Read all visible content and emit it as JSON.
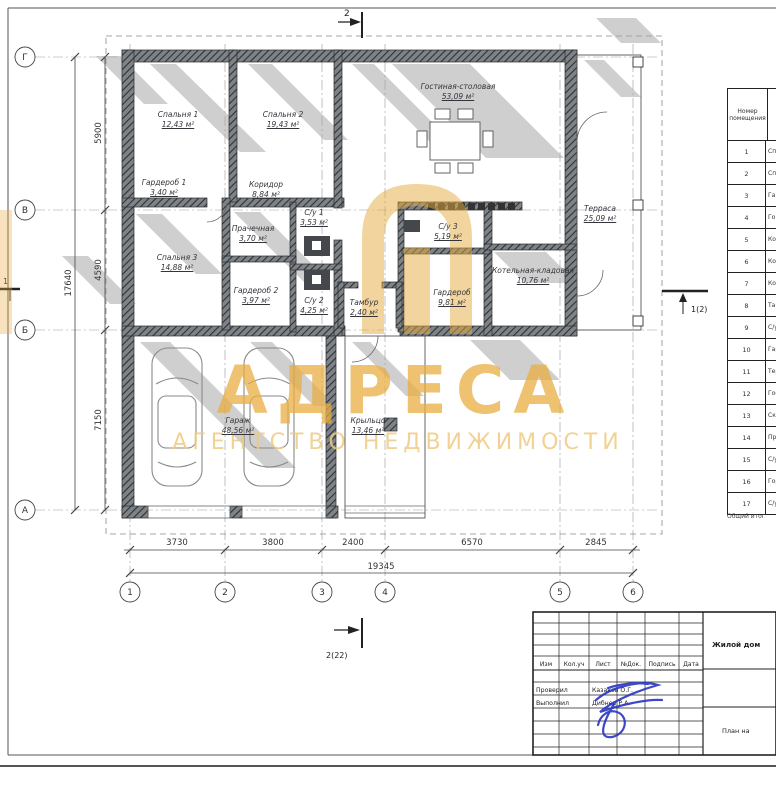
{
  "watermark": {
    "title": "АДРЕСА",
    "subtitle": "АГЕНТСТВО НЕДВИЖИМОСТИ",
    "accent_color": "#e8ad42"
  },
  "axes": {
    "rows": [
      "Г",
      "В",
      "Б",
      "А"
    ],
    "cols": [
      "1",
      "2",
      "3",
      "4",
      "5",
      "6"
    ]
  },
  "dimensions": {
    "bottom_segments": [
      "3730",
      "3800",
      "2400",
      "6570",
      "2845"
    ],
    "bottom_total": "19345",
    "left_segments": [
      "5900",
      "4590",
      "7150"
    ],
    "left_total": "17640"
  },
  "section_marks": {
    "top": "2",
    "bottom": "2(22)",
    "right": "1(2)",
    "left": "1"
  },
  "rooms": [
    {
      "name": "Спальня 1",
      "area": "12,43 м²"
    },
    {
      "name": "Спальня 2",
      "area": "19,43 м²"
    },
    {
      "name": "Гостиная-столовая",
      "area": "53,09 м²"
    },
    {
      "name": "Гардероб 1",
      "area": "3,40 м²"
    },
    {
      "name": "Коридор",
      "area": "8,84 м²"
    },
    {
      "name": "С/у 1",
      "area": "3,53 м²"
    },
    {
      "name": "Прачечная",
      "area": "3,70 м²"
    },
    {
      "name": "Спальня 3",
      "area": "14,88 м²"
    },
    {
      "name": "Гардероб 2",
      "area": "3,97 м²"
    },
    {
      "name": "С/у 2",
      "area": "4,25 м²"
    },
    {
      "name": "С/у 3",
      "area": "5,19 м²"
    },
    {
      "name": "Тамбур",
      "area": "2,40 м²"
    },
    {
      "name": "Гардероб",
      "area": "9,81 м²"
    },
    {
      "name": "Котельная-кладовая",
      "area": "10,76 м²"
    },
    {
      "name": "Терраса",
      "area": "25,09 м²"
    },
    {
      "name": "Гараж",
      "area": "48,56 м²"
    },
    {
      "name": "Крыльцо",
      "area": "13,46 м²"
    }
  ],
  "legend_table": {
    "header": "Номер помещения",
    "rows": [
      {
        "num": "1",
        "name": "Сп"
      },
      {
        "num": "2",
        "name": "Сп"
      },
      {
        "num": "3",
        "name": "Га"
      },
      {
        "num": "4",
        "name": "Го"
      },
      {
        "num": "5",
        "name": "Ко"
      },
      {
        "num": "6",
        "name": "Ко"
      },
      {
        "num": "7",
        "name": "Ко"
      },
      {
        "num": "8",
        "name": "Та"
      },
      {
        "num": "9",
        "name": "С/у"
      },
      {
        "num": "10",
        "name": "Гар"
      },
      {
        "num": "11",
        "name": "Тер"
      },
      {
        "num": "12",
        "name": "Гос"
      },
      {
        "num": "13",
        "name": "Ско"
      },
      {
        "num": "14",
        "name": "Про"
      },
      {
        "num": "15",
        "name": "С/у"
      },
      {
        "num": "16",
        "name": "Гор"
      },
      {
        "num": "17",
        "name": "С/у"
      }
    ],
    "footer": "Общий итог"
  },
  "title_block": {
    "columns": [
      "Изм",
      "Кол.уч",
      "Лист",
      "№Док.",
      "Подпись",
      "Дата"
    ],
    "checked_label": "Проверил",
    "checked_name": "Казаков О.Г.",
    "drawn_label": "Выполнил",
    "drawn_name": "Дибнер Р.А.",
    "project": "Жилой дом",
    "sheet_label": "План на"
  }
}
